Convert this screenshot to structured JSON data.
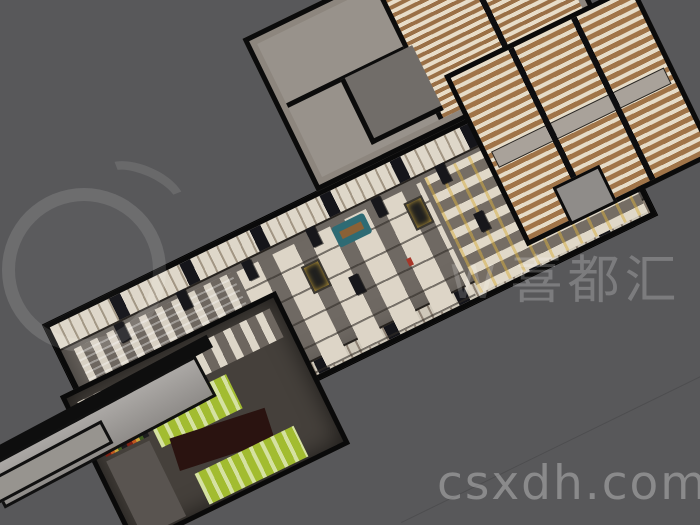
{
  "scene": {
    "description": "3D overhead architectural render of a large retail mall interior (porcelain and houseware market) shown diagonally on a gray background",
    "background_color": "#58585a",
    "palette": {
      "wall": "#0b0b0b",
      "floor": "#6f6963",
      "shelf_cream": "#ddd5c7",
      "wood": "#9a7046",
      "accent_green": "#a2bc30",
      "accent_gold": "#d6ae40",
      "accent_red": "#a73629",
      "accent_teal": "#2e6b74",
      "ramp_gray": "#a8a5a2"
    },
    "areas": [
      {
        "name": "main-hall"
      },
      {
        "name": "storage-rooms"
      },
      {
        "name": "right-wing-shelf-rooms"
      },
      {
        "name": "lower-annex"
      },
      {
        "name": "entrance-ramp"
      }
    ]
  },
  "watermarks": {
    "brand_prefix": "W",
    "brand_cn": "喜都汇",
    "website": "csxdh.com"
  }
}
